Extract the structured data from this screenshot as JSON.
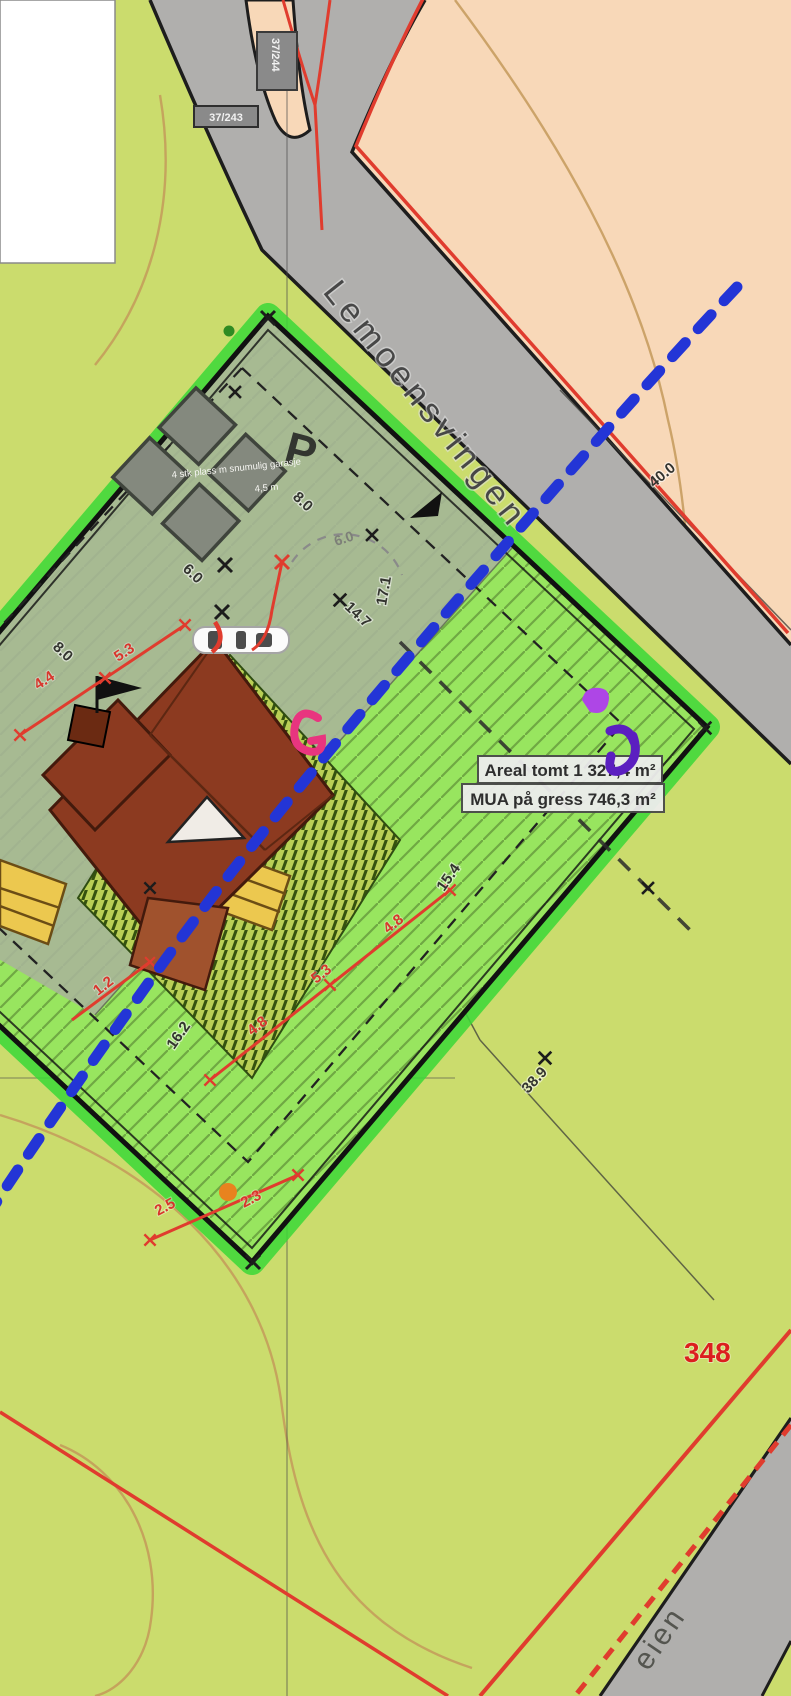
{
  "map": {
    "type": "site-plan",
    "streets": {
      "main": "Lemoensvingen",
      "bottom_fragment": "eien"
    },
    "road_number": "348",
    "area_box": {
      "line1": "Areal tomt 1 327,4 m²",
      "line2": "MUA på gress 746,3 m²"
    },
    "parking": {
      "letter": "P",
      "note_line1": "4 stk plass m snumulig garasje",
      "note_line2": "4,5 m"
    },
    "tags": {
      "vertical": "37/244",
      "horizontal": "37/243"
    },
    "dimensions": [
      {
        "value": "8.0",
        "color": "black"
      },
      {
        "value": "6.0",
        "color": "gray"
      },
      {
        "value": "14.7",
        "color": "black"
      },
      {
        "value": "17.1",
        "color": "black"
      },
      {
        "value": "6.0",
        "color": "black"
      },
      {
        "value": "8.0",
        "color": "black"
      },
      {
        "value": "4.4",
        "color": "red"
      },
      {
        "value": "5.3",
        "color": "red"
      },
      {
        "value": "1.2",
        "color": "red"
      },
      {
        "value": "4.8",
        "color": "red"
      },
      {
        "value": "5.3",
        "color": "red"
      },
      {
        "value": "4.8",
        "color": "red"
      },
      {
        "value": "15.4",
        "color": "black"
      },
      {
        "value": "16.2",
        "color": "black"
      },
      {
        "value": "38.9",
        "color": "black"
      },
      {
        "value": "40.0",
        "color": "black"
      },
      {
        "value": "2.5",
        "color": "red"
      },
      {
        "value": "2.3",
        "color": "red"
      }
    ],
    "colors": {
      "background_green": "#cbdc6d",
      "plot_hatch_green": "#98e55f",
      "plot_glow_green": "#3bd837",
      "overlay_gray_green": "#a8b49a",
      "peach": "#f8d8b8",
      "road_gray": "#b0afad",
      "house_brown": "#8c3a20",
      "stairs_yellow": "#ecc84f",
      "terrace_yellow_green": "#b9cf55",
      "boundary_blue": "#2335d6",
      "accent_red": "#e03c2e",
      "marker_pink": "#e8357f",
      "marker_purple": "#5b1fc0",
      "orange_point": "#e8831e"
    }
  }
}
